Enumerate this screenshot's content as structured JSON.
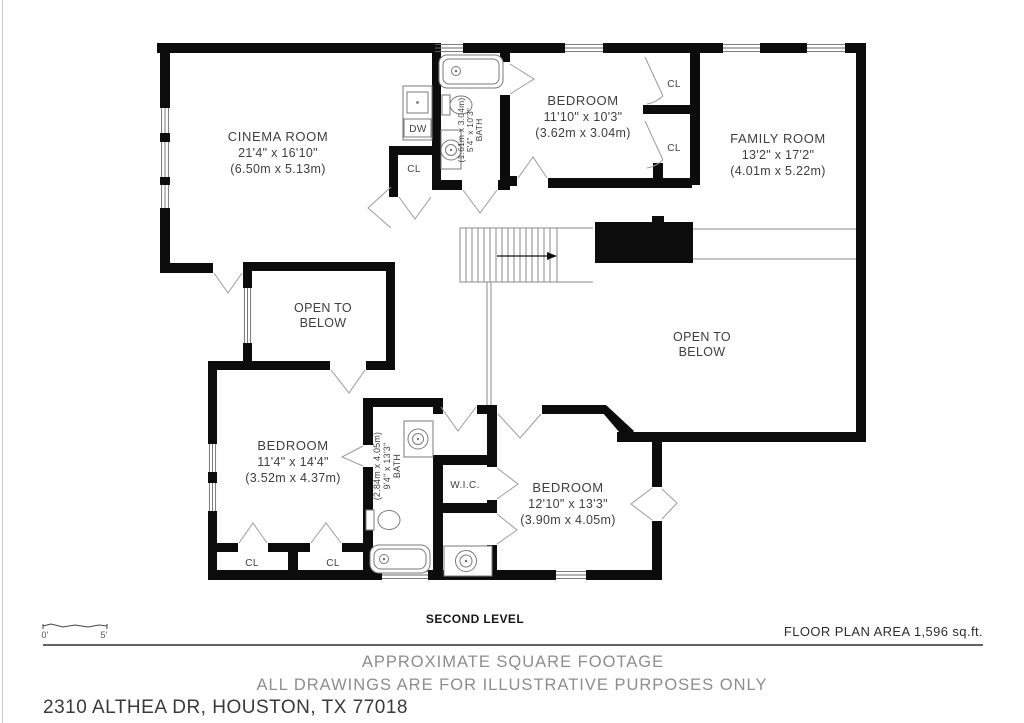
{
  "plan": {
    "cinema_name": "CINEMA ROOM",
    "cinema_dims": "21'4\" x 16'10\"",
    "cinema_metric": "(6.50m x 5.13m)",
    "bed_top_name": "BEDROOM",
    "bed_top_dims": "11'10\" x 10'3\"",
    "bed_top_metric": "(3.62m x 3.04m)",
    "family_name": "FAMILY ROOM",
    "family_dims": "13'2\" x 17'2\"",
    "family_metric": "(4.01m x 5.22m)",
    "open_below_line1": "OPEN TO",
    "open_below_line2": "BELOW",
    "bed_left_name": "BEDROOM",
    "bed_left_dims": "11'4\" x 14'4\"",
    "bed_left_metric": "(3.52m x 4.37m)",
    "bed_bottom_name": "BEDROOM",
    "bed_bottom_dims": "12'10\" x 13'3\"",
    "bed_bottom_metric": "(3.90m x 4.05m)",
    "bath_top_name": "BATH",
    "bath_top_dims": "5'4\" x 10'3\"",
    "bath_top_metric": "(1.61m x 3.04m)",
    "bath_bottom_name": "BATH",
    "bath_bottom_dims": "9'4\" x 13'3\"",
    "bath_bottom_metric": "(2.84m x 4.05m)",
    "wic": "W.I.C.",
    "dw": "DW",
    "cl": "CL",
    "scale_zero": "0'",
    "scale_five": "5'"
  },
  "footer": {
    "level": "SECOND LEVEL",
    "area": "FLOOR PLAN AREA 1,596 sq.ft.",
    "note1": "APPROXIMATE SQUARE FOOTAGE",
    "note2": "ALL DRAWINGS ARE FOR ILLUSTRATIVE PURPOSES ONLY",
    "address": "2310 ALTHEA DR, HOUSTON, TX 77018"
  }
}
